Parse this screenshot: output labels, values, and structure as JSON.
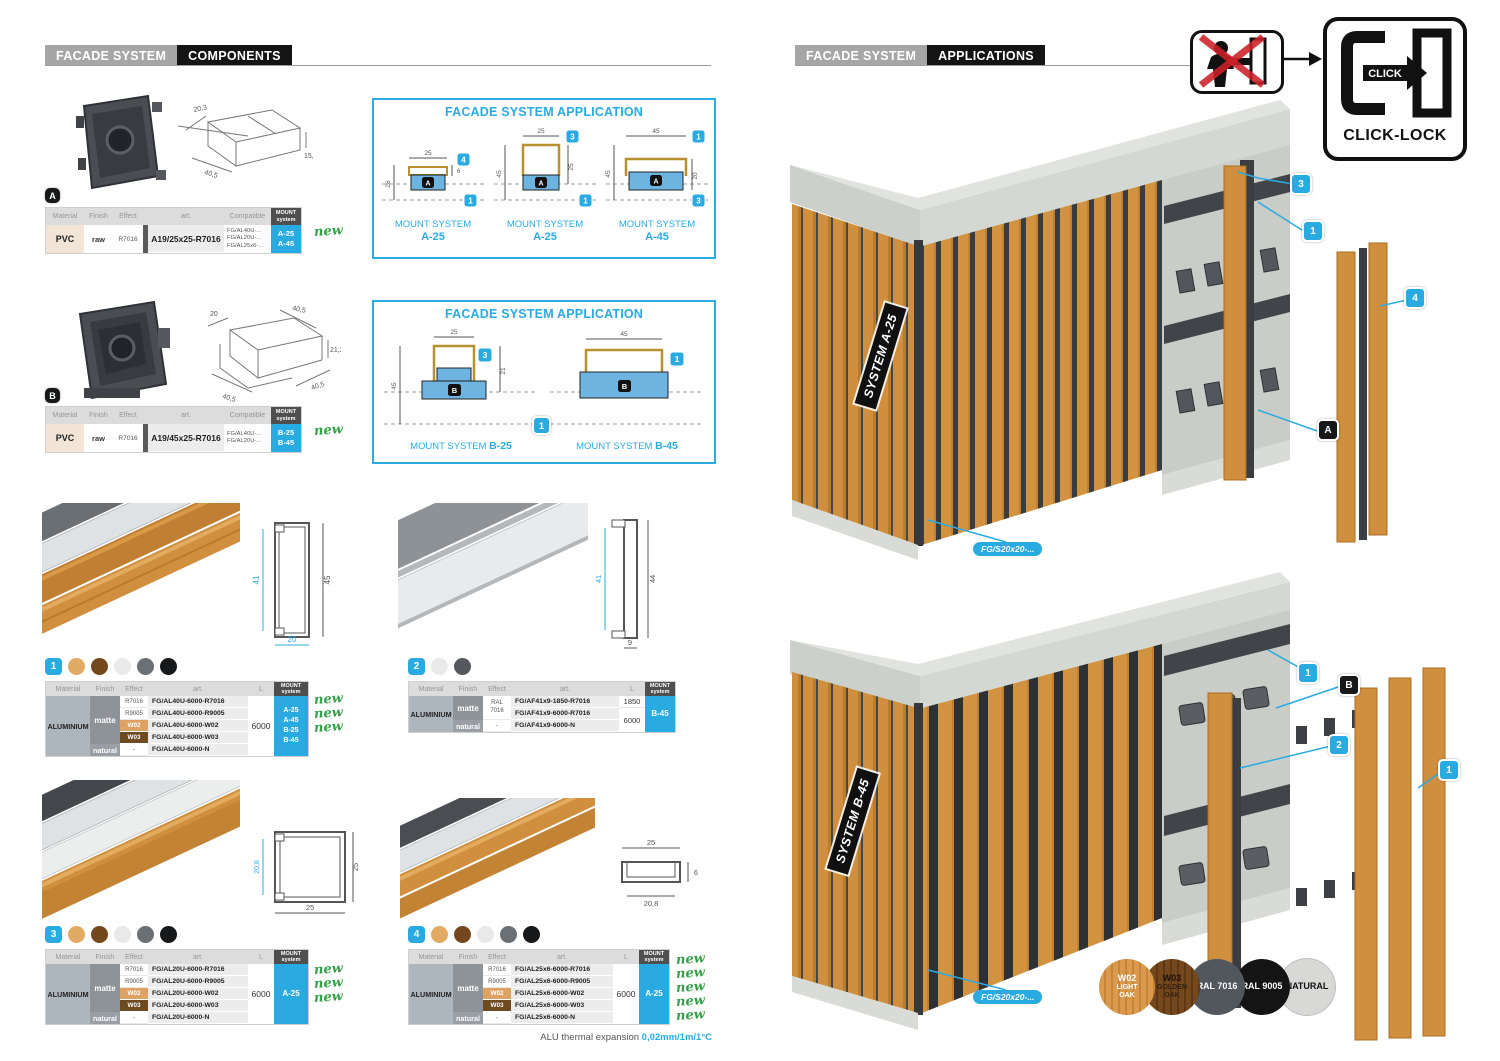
{
  "colors": {
    "accent_blue": "#29abe2",
    "new_green": "#35a04a",
    "wood": "#cf8f3f",
    "wood_dark": "#74471d",
    "concrete": "#ccd0ca",
    "profile_dark": "#3f4347"
  },
  "left": {
    "header": {
      "brand": "FACADE SYSTEM",
      "section": "COMPONENTS"
    },
    "th": {
      "material": "Material",
      "finish": "Finish",
      "effect": "Effect",
      "art": "art.",
      "compatible": "Compatible",
      "length": "L",
      "mount1": "MOUNT",
      "mount2": "system"
    },
    "comp_a": {
      "marker": "A",
      "dims": {
        "d1": "20,3",
        "d2": "40,5",
        "d3": "15,1"
      },
      "material": "PVC",
      "finish": "raw",
      "effect": "R7016",
      "art": "A19/25x25-R7016",
      "compat": [
        "FG/AL40U-...",
        "FG/AL20U-...",
        "FG/AL25x6-..."
      ],
      "mount": [
        "A-25",
        "A-45"
      ],
      "new": "new",
      "app_title": "FACADE SYSTEM APPLICATION",
      "d1": {
        "cap1": "MOUNT SYSTEM",
        "cap2": "A-25",
        "top": "25",
        "left": "26",
        "h6": "6",
        "badge": "4",
        "marker": "A",
        "lbadge": "1"
      },
      "d2": {
        "cap1": "MOUNT SYSTEM",
        "cap2": "A-25",
        "top": "25",
        "left": "45",
        "right": "25",
        "badge": "3",
        "marker": "A",
        "lbadge": "1"
      },
      "d3": {
        "cap1": "MOUNT SYSTEM",
        "cap2": "A-45",
        "top": "45",
        "left": "45",
        "right": "20",
        "badge": "1",
        "marker": "A",
        "lbadge": "3"
      }
    },
    "comp_b": {
      "marker": "B",
      "dims": {
        "d1": "20",
        "d2": "40,5",
        "d3": "21,2",
        "d4": "40,5",
        "d5": "40,5"
      },
      "material": "PVC",
      "finish": "raw",
      "effect": "R7016",
      "art": "A19/45x25-R7016",
      "compat": [
        "FG/AL40U-...",
        "FG/AL20U-..."
      ],
      "mount": [
        "B-25",
        "B-45"
      ],
      "new": "new",
      "app_title": "FACADE SYSTEM APPLICATION",
      "d1": {
        "cap1": "MOUNT SYSTEM",
        "cap2": "B-25",
        "top": "25",
        "left": "45",
        "right": "21",
        "badge": "3",
        "marker": "B",
        "lbadge": "1"
      },
      "d2": {
        "cap1": "MOUNT SYSTEM",
        "cap2": "B-45",
        "top": "45",
        "badge": "1",
        "marker": "B"
      }
    },
    "p1": {
      "num": "1",
      "cs": {
        "left": "41",
        "right": "45",
        "bottom": "20"
      },
      "material": "ALUMINIUM",
      "matte": "matte",
      "natural": "natural",
      "length": "6000",
      "rows": [
        {
          "e": "R7016",
          "a": "FG/AL40U-6000-R7016"
        },
        {
          "e": "R9005",
          "a": "FG/AL40U-6000-R9005"
        },
        {
          "e": "W02",
          "a": "FG/AL40U-6000-W02"
        },
        {
          "e": "W03",
          "a": "FG/AL40U-6000-W03"
        },
        {
          "e": "-",
          "a": "FG/AL40U-6000-N"
        }
      ],
      "mount": [
        "A-25",
        "A-45",
        "B-25",
        "B-45"
      ],
      "new": "new"
    },
    "p2": {
      "num": "2",
      "cs": {
        "left": "41",
        "right": "44",
        "bottom": "9"
      },
      "material": "ALUMINIUM",
      "matte": "matte",
      "natural": "natural",
      "eff1": "RAL",
      "eff2": "7016",
      "eff3": "-",
      "a1": "FG/AF41x9-1850-R7016",
      "a2": "FG/AF41x9-6000-R7016",
      "a3": "FG/AF41x9-6000-N",
      "l1": "1850",
      "l2": "6000",
      "mount": "B-45"
    },
    "p3": {
      "num": "3",
      "cs": {
        "left": "20,8",
        "right": "25",
        "bottom": "25"
      },
      "material": "ALUMINIUM",
      "matte": "matte",
      "natural": "natural",
      "length": "6000",
      "rows": [
        {
          "e": "R7016",
          "a": "FG/AL20U-6000-R7016"
        },
        {
          "e": "R9005",
          "a": "FG/AL20U-6000-R9005"
        },
        {
          "e": "W02",
          "a": "FG/AL20U-6000-W02"
        },
        {
          "e": "W03",
          "a": "FG/AL20U-6000-W03"
        },
        {
          "e": "-",
          "a": "FG/AL20U-6000-N"
        }
      ],
      "mount": "A-25",
      "new": "new"
    },
    "p4": {
      "num": "4",
      "cs": {
        "top": "25",
        "bottom": "20,8",
        "right": "6"
      },
      "material": "ALUMINIUM",
      "matte": "matte",
      "natural": "natural",
      "length": "6000",
      "rows": [
        {
          "e": "R7016",
          "a": "FG/AL25x6-6000-R7016"
        },
        {
          "e": "R9005",
          "a": "FG/AL25x6-6000-R9005"
        },
        {
          "e": "W02",
          "a": "FG/AL25x6-6000-W02"
        },
        {
          "e": "W03",
          "a": "FG/AL25x6-6000-W03"
        },
        {
          "e": "-",
          "a": "FG/AL25x6-6000-N"
        }
      ],
      "mount": "A-25",
      "new": "new"
    },
    "thermal": {
      "label": "ALU thermal expansion ",
      "value": "0,02mm/1m/1°C"
    }
  },
  "right": {
    "header": {
      "brand": "FACADE SYSTEM",
      "section": "APPLICATIONS"
    },
    "clicklock": {
      "click": "CLICK",
      "label": "CLICK-LOCK"
    },
    "render_a": {
      "system": "SYSTEM A-25",
      "part": "FG/S20x20-...",
      "c1": "3",
      "c2": "1",
      "c3": "4",
      "c4": "A"
    },
    "render_b": {
      "system": "SYSTEM B-45",
      "part": "FG/S20x20-...",
      "c1": "1",
      "c2": "B",
      "c3": "2",
      "c4": "1"
    },
    "swatches": [
      {
        "l1": "W02",
        "l2": "LIGHT",
        "l3": "OAK",
        "color": "#d99a4e"
      },
      {
        "l1": "W03",
        "l2": "GOLDEN",
        "l3": "OAK",
        "color": "#74471d"
      },
      {
        "l1": "RAL 7016",
        "color": "#51575d"
      },
      {
        "l1": "RAL 9005",
        "color": "#141414"
      },
      {
        "l1": "NATURAL",
        "color": "#d8d9d7"
      }
    ]
  }
}
